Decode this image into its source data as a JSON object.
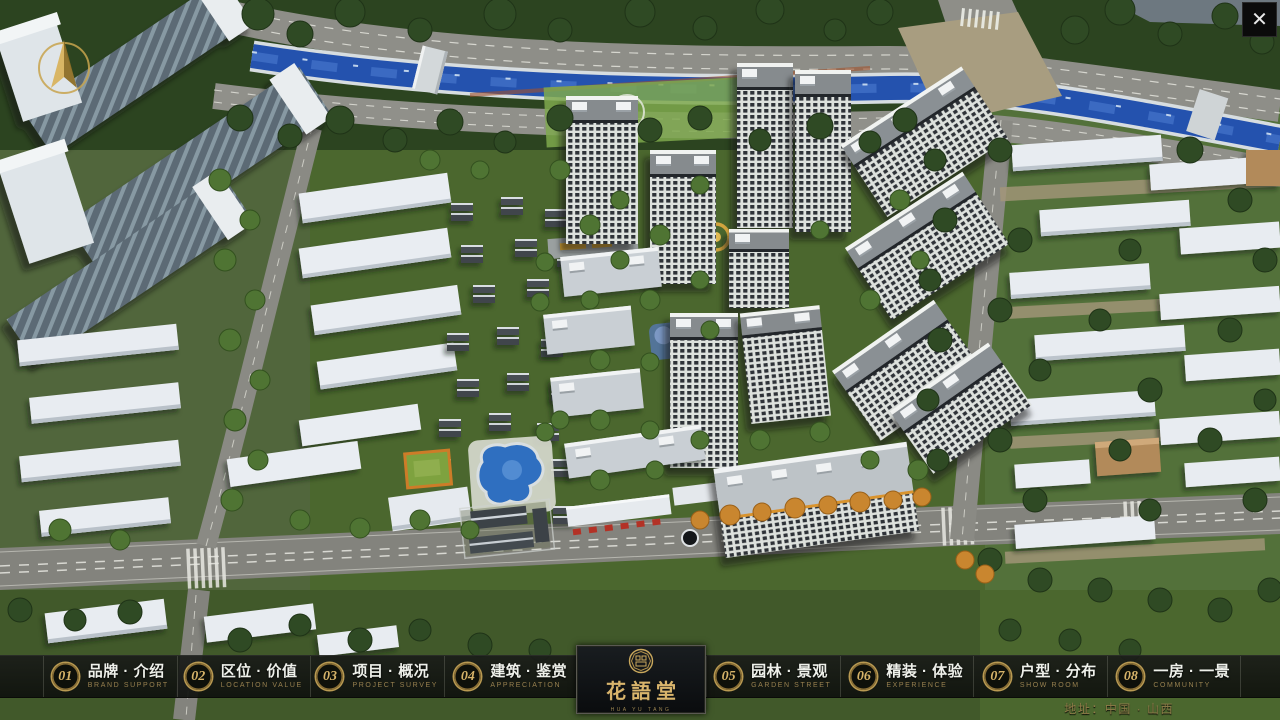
{
  "app": {
    "type": "residential-sales-presentation"
  },
  "close_button": {
    "icon": "✕"
  },
  "compass": {
    "icon": "north-arrow"
  },
  "nav": {
    "items": [
      {
        "num": "01",
        "zh": "品牌 · 介绍",
        "en": "BRAND SUPPORT"
      },
      {
        "num": "02",
        "zh": "区位 · 价值",
        "en": "LOCATION VALUE"
      },
      {
        "num": "03",
        "zh": "项目 · 概况",
        "en": "PROJECT SURVEY"
      },
      {
        "num": "04",
        "zh": "建筑 · 鉴赏",
        "en": "APPRECIATION"
      },
      {
        "num": "05",
        "zh": "园林 · 景观",
        "en": "GARDEN STREET"
      },
      {
        "num": "06",
        "zh": "精装 · 体验",
        "en": "EXPERIENCE"
      },
      {
        "num": "07",
        "zh": "户型 · 分布",
        "en": "SHOW ROOM"
      },
      {
        "num": "08",
        "zh": "一房 · 一景",
        "en": "COMMUNITY"
      }
    ]
  },
  "logo": {
    "zh": "花語堂",
    "tagline": "HUA YU TANG"
  },
  "footer": {
    "address": "地址：中国 · 山西"
  },
  "palette": {
    "gold": "#c8a45c",
    "bar_bg": "#121412",
    "river": "#2452ae",
    "road": "#8a8a84",
    "grass": "#4b672e",
    "tree_dark": "#2f4a24",
    "tower_facade": "#dde1dd",
    "tower_window": "#2d3338",
    "orange_tree": "#c9862f",
    "pool": "#2f6fc0"
  }
}
